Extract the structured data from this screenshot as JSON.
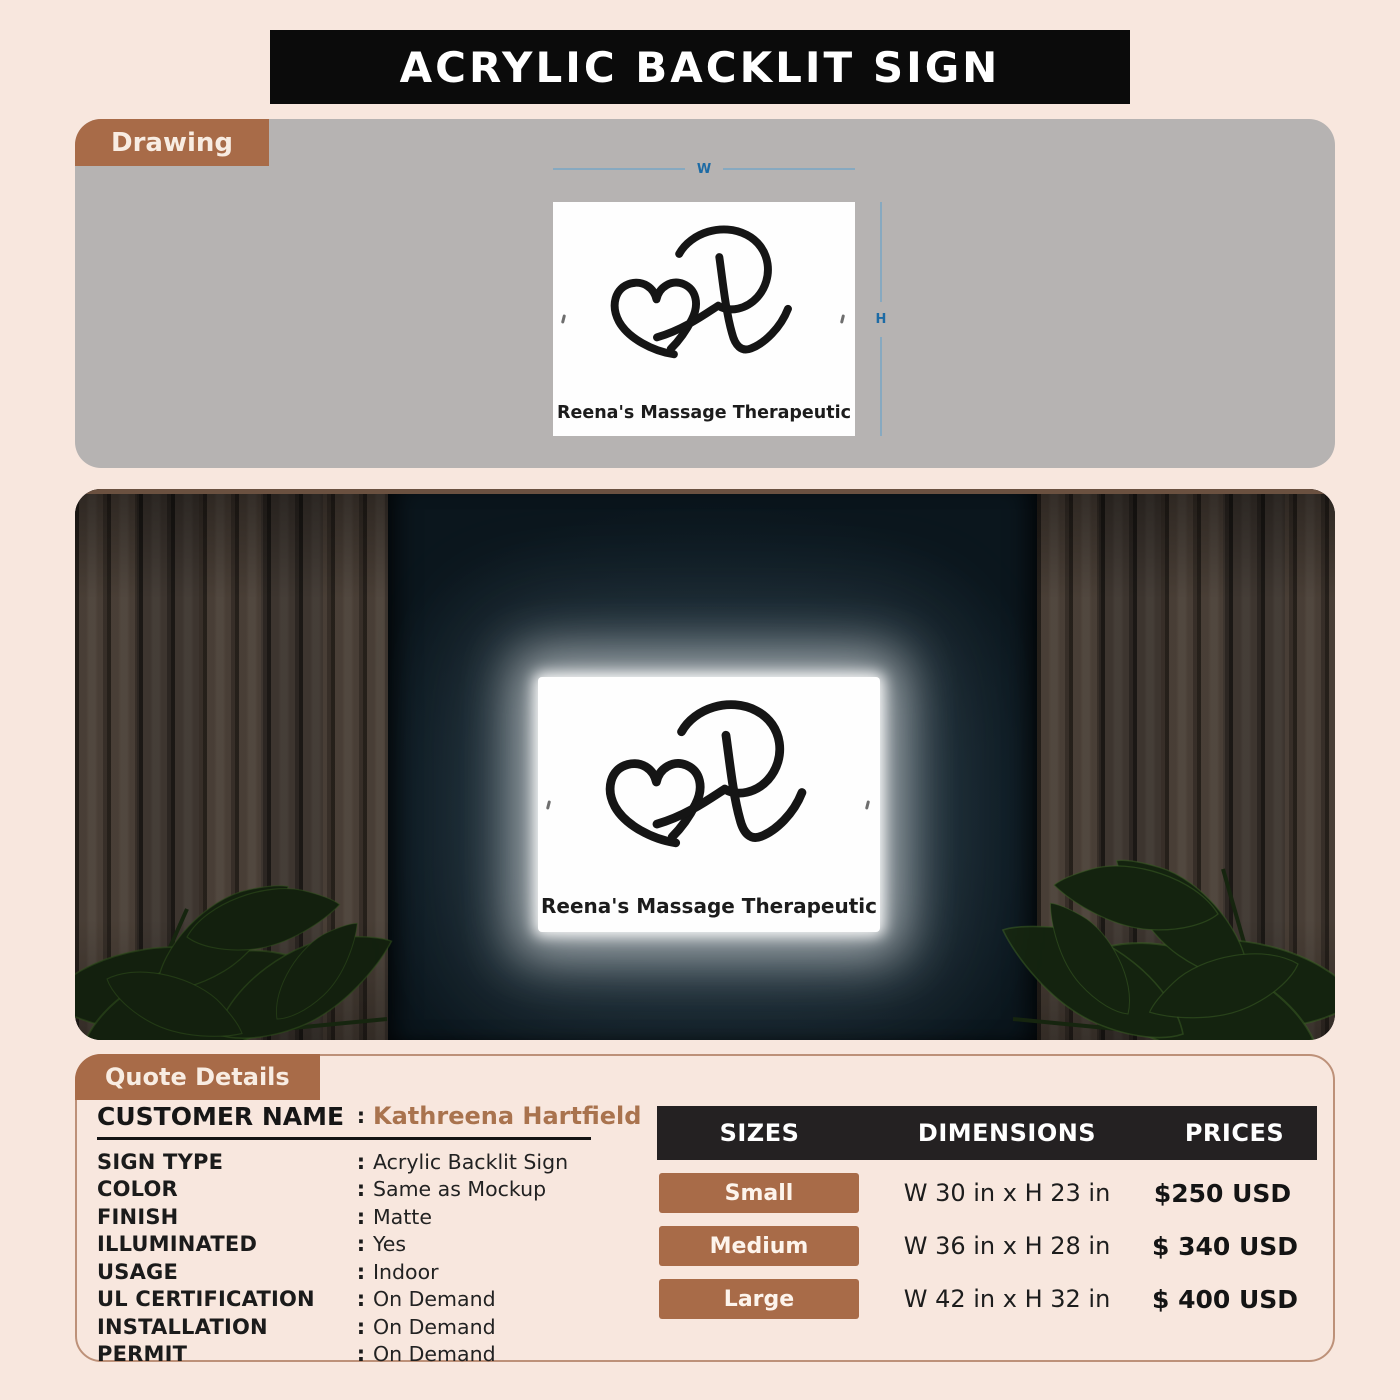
{
  "title": "ACRYLIC BACKLIT SIGN",
  "colors": {
    "page_background": "#f8e7de",
    "banner_black": "#0b0b0b",
    "accent_brown": "#a86b48",
    "drawing_gray": "#b6b3b2",
    "table_header_black": "#242122",
    "dimension_blue": "#1d6ba5",
    "customer_name_brown": "#a9734e",
    "mockup_wall_teal": "#12222c"
  },
  "drawing": {
    "tab": "Drawing",
    "width_label": "W",
    "height_label": "H",
    "sign_text": "Reena's Massage Therapeutic"
  },
  "mockup": {
    "tab": "Mockup",
    "sign_text": "Reena's Massage Therapeutic"
  },
  "quote": {
    "tab": "Quote Details",
    "customer": {
      "label": "CUSTOMER NAME",
      "value": "Kathreena Hartfield"
    },
    "fields": [
      {
        "label": "SIGN TYPE",
        "value": "Acrylic Backlit Sign"
      },
      {
        "label": "COLOR",
        "value": "Same as Mockup"
      },
      {
        "label": "FINISH",
        "value": "Matte"
      },
      {
        "label": "ILLUMINATED",
        "value": "Yes"
      },
      {
        "label": "USAGE",
        "value": "Indoor"
      },
      {
        "label": "UL CERTIFICATION",
        "value": "On Demand"
      },
      {
        "label": "INSTALLATION",
        "value": "On Demand"
      },
      {
        "label": "PERMIT",
        "value": "On Demand"
      }
    ]
  },
  "price_table": {
    "headers": [
      "SIZES",
      "DIMENSIONS",
      "PRICES"
    ],
    "rows": [
      {
        "size": "Small",
        "dimensions": "W 30 in x H 23 in",
        "price": "$250 USD"
      },
      {
        "size": "Medium",
        "dimensions": "W 36 in x H 28 in",
        "price": "$ 340 USD"
      },
      {
        "size": "Large",
        "dimensions": "W 42 in x H 32 in",
        "price": "$ 400 USD"
      }
    ]
  }
}
